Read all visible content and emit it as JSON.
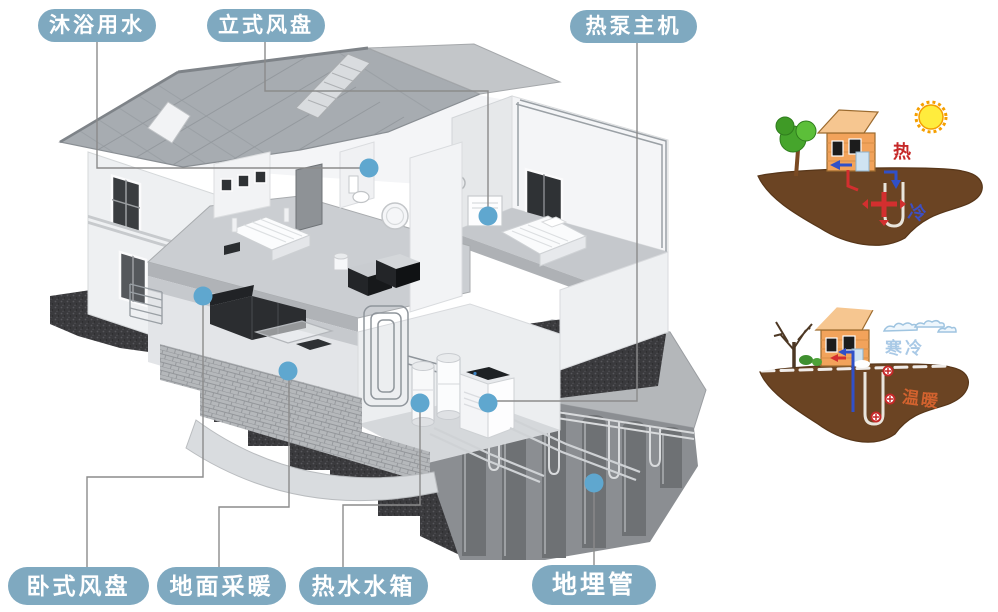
{
  "callouts": [
    {
      "id": "shower-water",
      "text": "沐浴用水"
    },
    {
      "id": "vertical-fan-coil",
      "text": "立式风盘"
    },
    {
      "id": "heat-pump-main-unit",
      "text": "热泵主机"
    },
    {
      "id": "horizontal-fan-coil",
      "text": "卧式风盘"
    },
    {
      "id": "floor-heating",
      "text": "地面采暖"
    },
    {
      "id": "hot-water-tank",
      "text": "热水水箱"
    },
    {
      "id": "buried-pipe",
      "text": "地埋管"
    }
  ],
  "insets": {
    "summer": {
      "air_label": "热",
      "underground_label": "冷"
    },
    "winter": {
      "air_label": "寒冷",
      "underground_label": "温暖"
    }
  },
  "colors": {
    "label_bg": "#7fa9c0",
    "label_text": "#ffffff",
    "marker_dot": "#5fa7cf",
    "callout_line": "#8b8b8b",
    "summer_hot_text": "#c62828",
    "summer_cold_text": "#3d4fc4",
    "winter_air_text": "#a9c9e6",
    "winter_ground_text": "#d2622e",
    "soil": "#6b4423",
    "cartoon_house_wall": "#f2a35b",
    "cartoon_roof": "#f6c690",
    "sun": "#ffec3d",
    "tree_green": "#46a52c"
  }
}
